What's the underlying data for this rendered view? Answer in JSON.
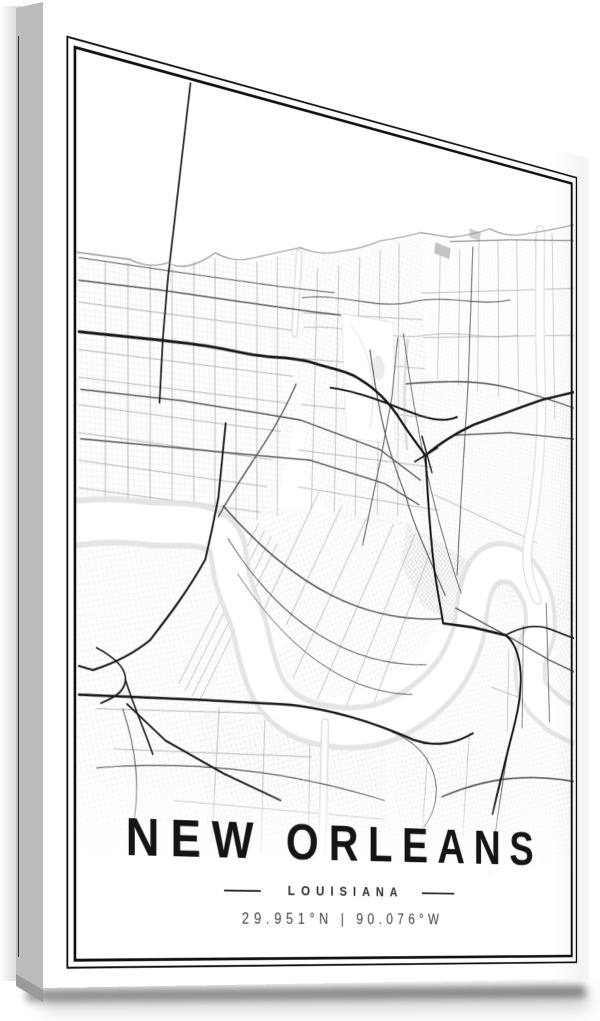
{
  "poster": {
    "title": "NEW ORLEANS",
    "region": "LOUISIANA",
    "coordinates": "29.951°N | 90.076°W"
  },
  "colors": {
    "title": "#141414",
    "subtitle": "#2d2d2d",
    "coords": "#3c3c3c",
    "frame": "#101010",
    "highway": "#161616",
    "arterial": "#565656",
    "minor": "#ababab",
    "grid": "#d7d7d7",
    "wateredge": "#e2e2e2",
    "sidea": "#bcbcbc",
    "sideb": "#a7a7a7",
    "wrapline": "#1f1f1f"
  }
}
